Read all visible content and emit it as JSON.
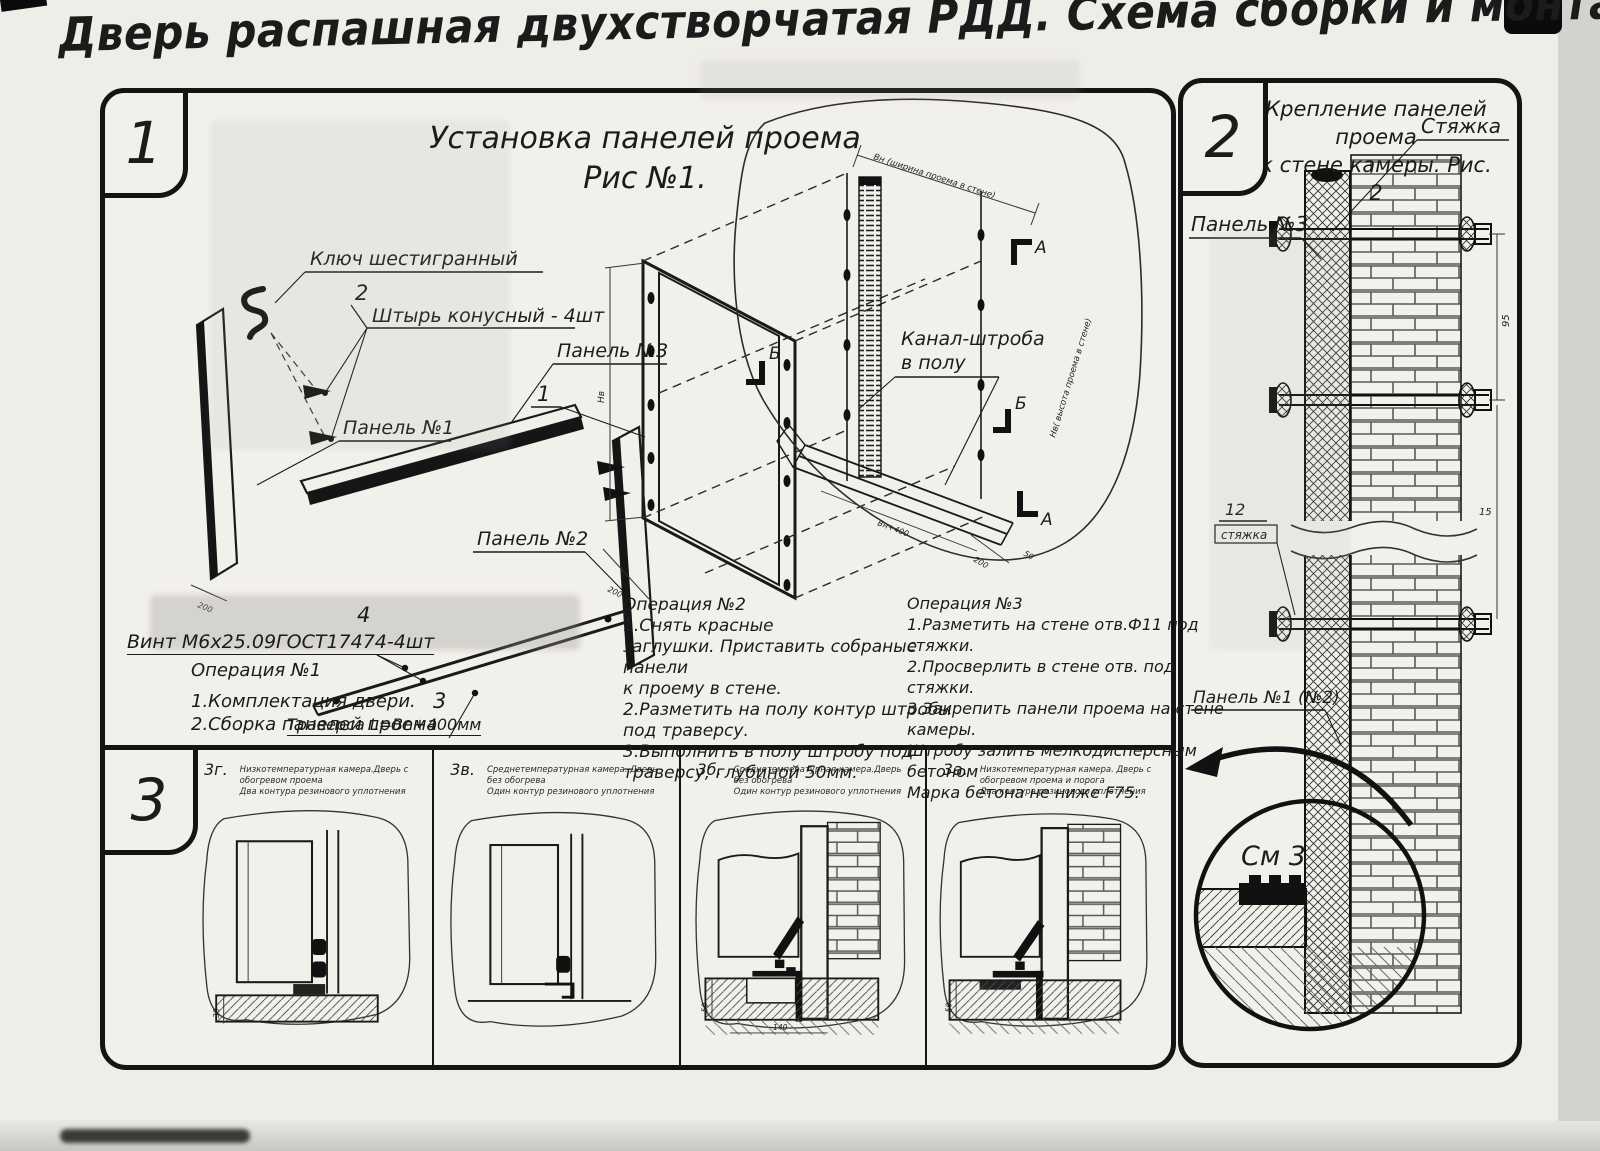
{
  "title": "Дверь распашная двухстворчатая РДД.  Схема сборки и монтажа №2",
  "colors": {
    "ink": "#1b1b1b",
    "paper": "#f2f0ea",
    "page": "#e9e7e2"
  },
  "section1": {
    "badge": "1",
    "heading1": "Установка панелей проема",
    "heading2": "Рис №1.",
    "labels": {
      "hex_key": "Ключ шестигранный",
      "pin_num": "2",
      "pin": "Штырь конусный - 4шт",
      "panel3": "Панель №3",
      "panel1": "Панель №1",
      "panel2": "Панель №2",
      "item_num": "1",
      "screw_num": "4",
      "screw": "Винт М6х25.09ГОСТ17474-4шт",
      "traverse_num": "3",
      "traverse": "Траверса  L=Bn+400мм",
      "channel1": "Канал-штроба",
      "channel2": "в полу",
      "marker_a": "А",
      "marker_b": "Б"
    },
    "dims": {
      "d200": "200",
      "d50": "50",
      "dvn": "Вн+400",
      "dnv": "Нв",
      "top_note": "Вн (ширина проема в стене)",
      "side_note": "Нв( высота проема в стене)"
    },
    "op1": {
      "title": "Операция №1",
      "lines": [
        "1.Комплектация двери.",
        "2.Сборка панелей проема"
      ]
    },
    "op2": {
      "title": "Операция №2",
      "lines": [
        "1.Снять  красные",
        "заглушки. Приставить собраные панели",
        "к проему в стене.",
        "2.Разметить на полу контур штробы",
        "под траверсу.",
        "3.Выполнить в полу штробу под",
        "траверсу, глубиной 50мм."
      ]
    },
    "op3": {
      "title": "Операция №3",
      "lines": [
        "1.Разметить на стене отв.Ф11 под",
        "стяжки.",
        "2.Просверлить в стене отв.   под",
        "стяжки.",
        "3.Закрепить панели проема на стене камеры.",
        "Штробу залить мелкодисперсным бетоном",
        "Марка бетона не ниже   F75."
      ]
    }
  },
  "section2": {
    "badge": "2",
    "heading1": "Крепление панелей проема",
    "heading2": "к стене камеры. Рис. 2",
    "labels": {
      "tie": "Стяжка",
      "panel3": "Панель №3",
      "tie_num": "12",
      "tie_word": "стяжка",
      "panel12": "Панель №1 (№2)",
      "see3": "См 3"
    },
    "dims": {
      "d95": "95",
      "d15": "15"
    }
  },
  "section3": {
    "badge": "3",
    "items": [
      {
        "code": "3г.",
        "line1": "Низкотемпературная камера.Дверь с обогревом проема",
        "line2": "Два контура резинового уплотнения"
      },
      {
        "code": "3в.",
        "line1": "Среднетемпературная камера. Дверь без обогрева",
        "line2": "Один контур резинового уплотнения"
      },
      {
        "code": "3б.",
        "line1": "Среднетемпературная камера.Дверь без обогрева",
        "line2": "Один контур резинового уплотнения"
      },
      {
        "code": "3а.",
        "line1": "Низкотемпературная камера. Дверь с обогревом проема и порога",
        "line2": "Два контура резинового уплотнения"
      }
    ],
    "dims": {
      "d30": "30",
      "d50": "50",
      "d140": "140"
    }
  }
}
